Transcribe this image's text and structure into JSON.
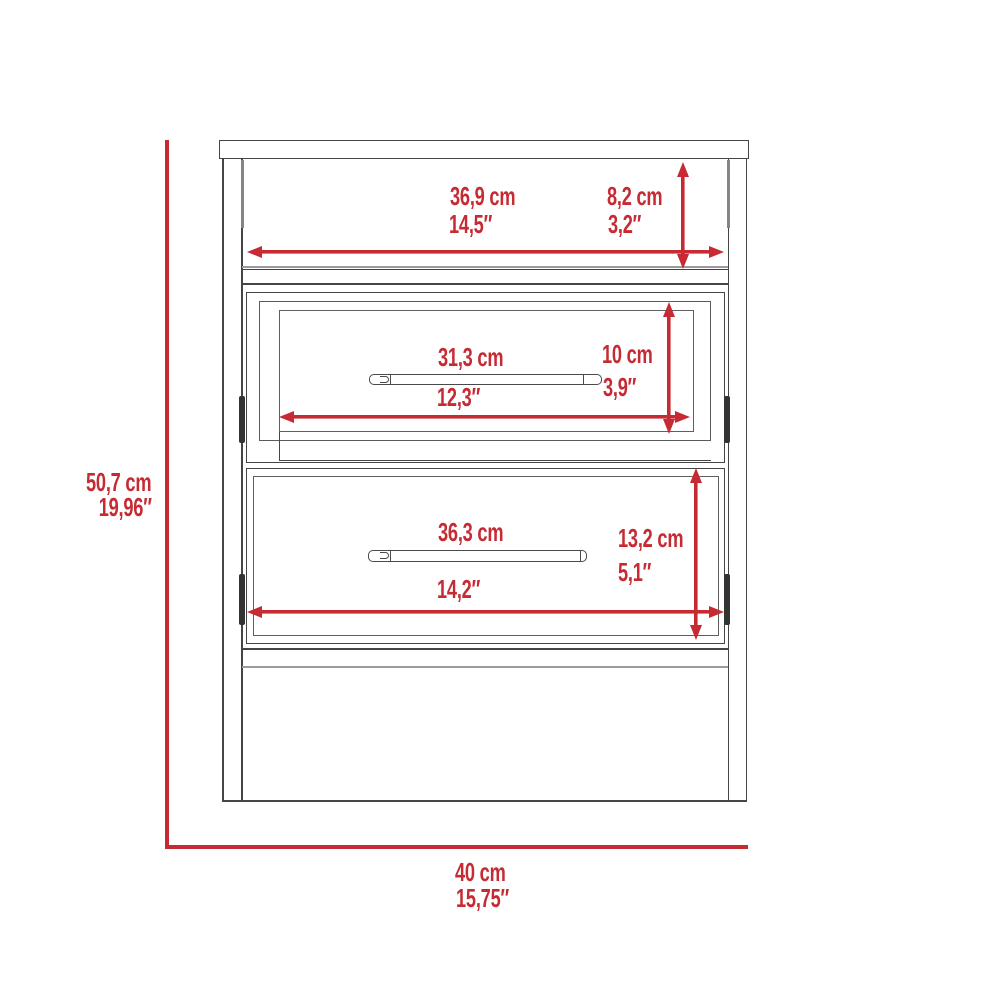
{
  "diagram": {
    "type": "furniture-dimension-drawing",
    "item": "two-drawer nightstand, front elevation",
    "colors": {
      "dimension_red": "#c62a33",
      "outline_dark": "#454545",
      "outline_light": "#9b9b9b",
      "background": "#ffffff"
    },
    "dimensions": {
      "overall_height": {
        "cm": "50,7 cm",
        "inches": "19,96″"
      },
      "overall_width": {
        "cm": "40 cm",
        "inches": "15,75″"
      },
      "open_shelf_width": {
        "cm": "36,9 cm",
        "inches": "14,5″"
      },
      "open_shelf_height": {
        "cm": "8,2 cm",
        "inches": "3,2″"
      },
      "top_drawer_width": {
        "cm": "31,3 cm",
        "inches": "12,3″"
      },
      "top_drawer_height": {
        "cm": "10 cm",
        "inches": "3,9″"
      },
      "bottom_drawer_width": {
        "cm": "36,3 cm",
        "inches": "14,2″"
      },
      "bottom_drawer_height": {
        "cm": "13,2 cm",
        "inches": "5,1″"
      }
    }
  }
}
